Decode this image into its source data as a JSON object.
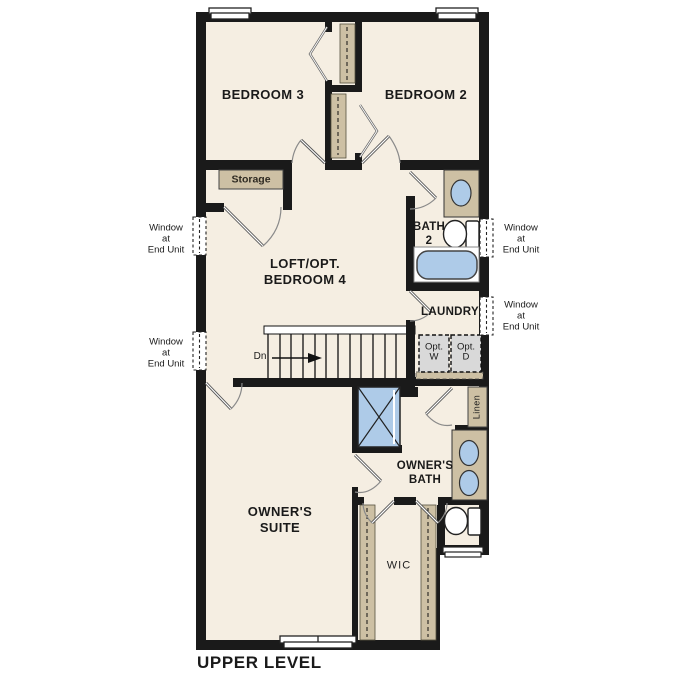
{
  "title": "UPPER LEVEL",
  "rooms": {
    "bedroom3": "BEDROOM 3",
    "bedroom2": "BEDROOM 2",
    "loft": "LOFT/OPT.\nBEDROOM 4",
    "bath2": "BATH\n2",
    "laundry": "LAUNDRY",
    "owners_suite": "OWNER'S\nSUITE",
    "owners_bath": "OWNER'S\nBATH",
    "wic": "WIC",
    "storage": "Storage",
    "linen": "Linen"
  },
  "annotations": {
    "window_end_unit": "Window\nat\nEnd Unit",
    "down": "Dn",
    "opt_washer": "Opt.\nW",
    "opt_dryer": "Opt.\nD"
  },
  "colors": {
    "floor": "#f5eee2",
    "wall": "#1a1a1a",
    "fixture_blue": "#aecbe8",
    "cabinet_tan": "#cdc0a4",
    "optional_gray": "#d9d9d9"
  }
}
